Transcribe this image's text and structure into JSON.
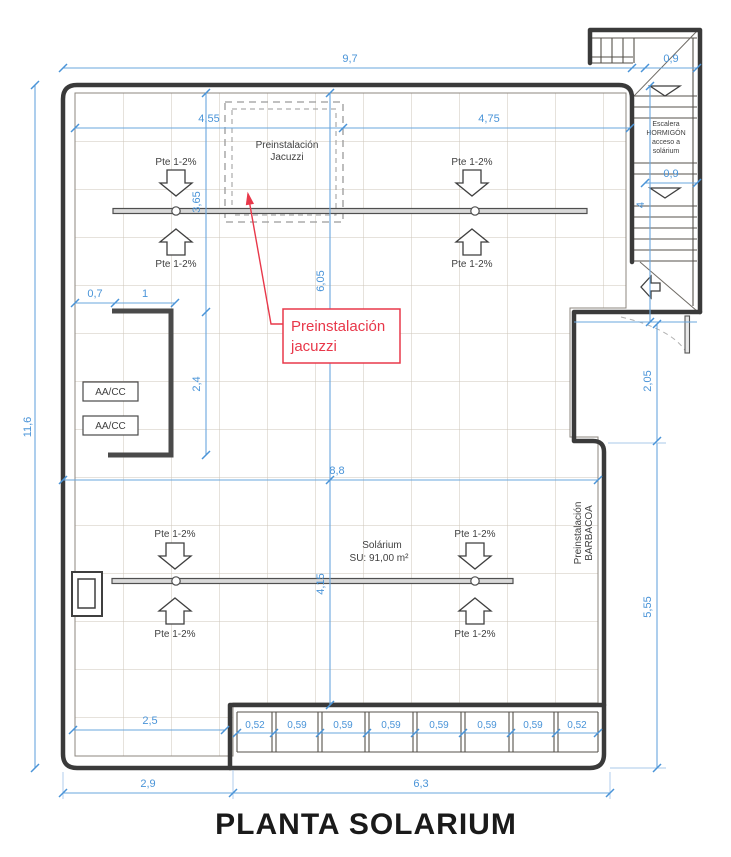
{
  "title": "PLANTA SOLARIUM",
  "labels": {
    "slope": "Pte 1-2%",
    "aacc": "AA/CC",
    "jacuzzi_area_line1": "Preinstalación",
    "jacuzzi_area_line2": "Jacuzzi",
    "solarium_name": "Solárium",
    "solarium_area": "SU: 91,00 m²",
    "barbacoa_line1": "Preinstalación",
    "barbacoa_line2": "BARBACOA",
    "stair_line1": "Escalera",
    "stair_line2": "HORMIGÓN",
    "stair_line3": "acceso a",
    "stair_line4": "solárium"
  },
  "callout": {
    "line1": "Preinstalación",
    "line2": "jacuzzi"
  },
  "dims": {
    "total_width": "9,7",
    "stair_width_top": "0,9",
    "left_height": "11,6",
    "roof_left": "4,55",
    "roof_right": "4,75",
    "jacuzzi_offset": "3,65",
    "center_height": "6,05",
    "aacc_gap": "0,7",
    "aacc_width": "1",
    "aacc_height": "2,4",
    "mid_width": "8,8",
    "stair_run": "4",
    "stair_width": "0,9",
    "landing_depth": "2,05",
    "right_height": "5,55",
    "lower_height": "4,15",
    "bottom_inner": "2,5",
    "bottom_left": "2,9",
    "bottom_right": "6,3",
    "slats": [
      "0,52",
      "0,59",
      "0,59",
      "0,59",
      "0,59",
      "0,59",
      "0,59",
      "0,52"
    ]
  },
  "colors": {
    "dimension": "#4a94d8",
    "annotation": "#e8384a",
    "wall": "#3a3a3a",
    "grid": "#cdc5ba"
  }
}
